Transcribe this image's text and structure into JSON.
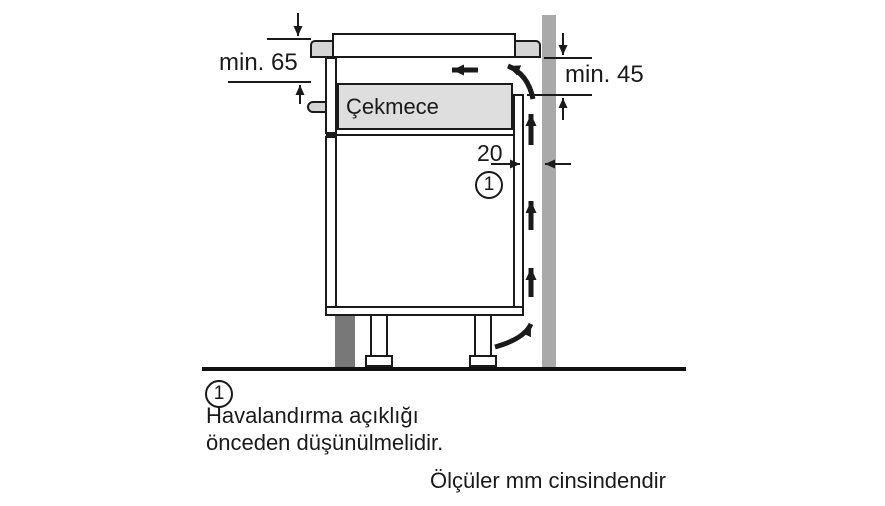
{
  "diagram": {
    "drawer_label": "Çekmece",
    "dimensions": {
      "front_clearance": "min. 65",
      "rear_clearance": "min. 45",
      "rear_gap": "20"
    },
    "callout_number": "1",
    "colors": {
      "line": "#1a1a1a",
      "worktop_gray": "#d5d5d5",
      "drawer_gray": "#dedede",
      "wall_gray": "#a9a9a9",
      "plinth_gray": "#787878"
    }
  },
  "legend": {
    "marker": "1",
    "lines": [
      "Havalandırma açıklığı",
      "önceden düşünülmelidir."
    ]
  },
  "footnote": "Ölçüler mm cinsindendir"
}
